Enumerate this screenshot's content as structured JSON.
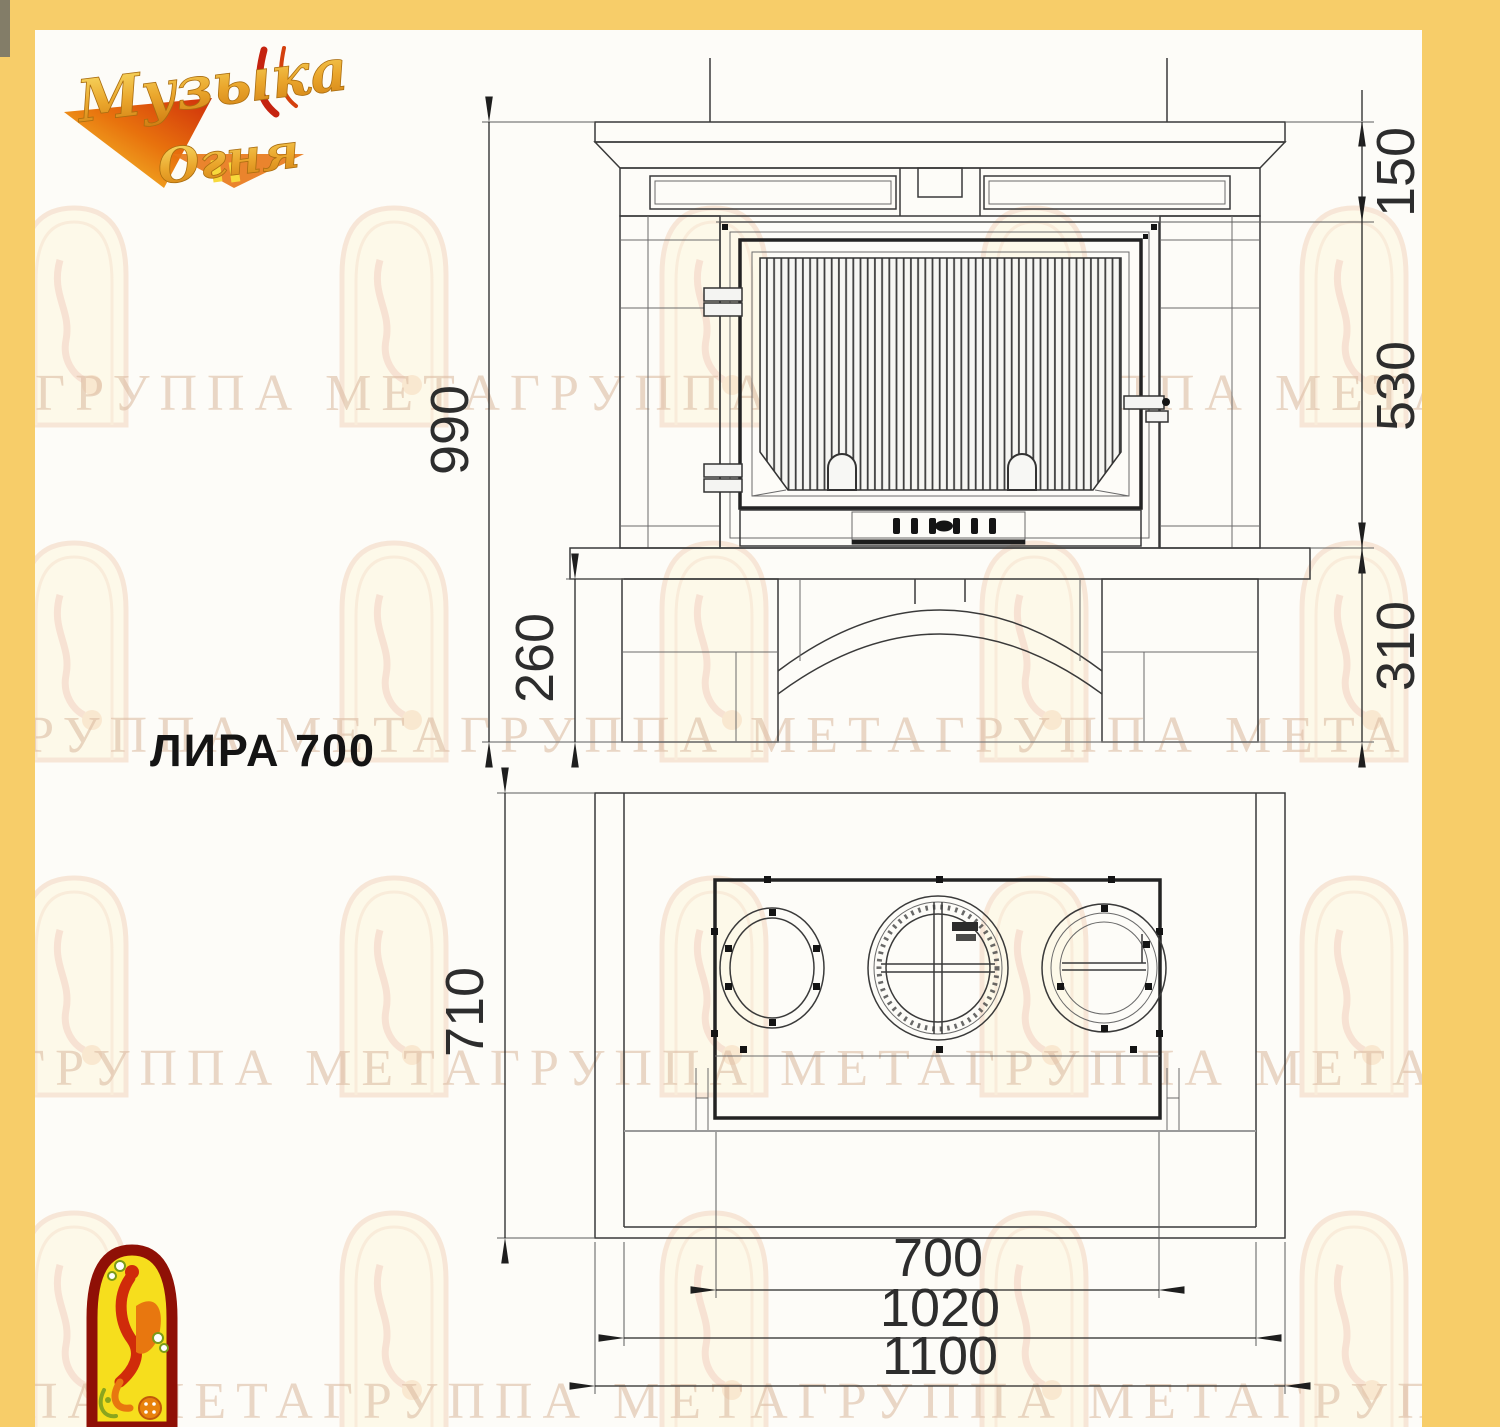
{
  "colors": {
    "frame_yellow": "#f7cd69",
    "paper_white": "#fdfcf8",
    "drawing_line": "#3a3a3a",
    "logo_gold": "#eaa62c",
    "logo_red": "#c52310",
    "firebird_arch_red": "#8f1006",
    "firebird_arch_yellow": "#f6de1d",
    "watermark_tone": "#dcbca4"
  },
  "brand_logo": {
    "word1": "Музыка",
    "word2": "Огня"
  },
  "model": {
    "label": "ЛИРА 700"
  },
  "front_view": {
    "dim_total_height": "990",
    "dim_mantel_height": "150",
    "dim_firebox_height": "530",
    "dim_base_height": "310",
    "dim_plinth_height": "260"
  },
  "plan_view": {
    "dim_depth": "710",
    "dim_insert_width": "700",
    "dim_platform_width": "1020",
    "dim_overall_width": "1100"
  },
  "watermark": {
    "rows": [
      "ГРУППА МЕТАГРУППА МЕТАГРУППА МЕТА",
      "ГРУППА МЕТАГРУППА МЕТАГРУППА МЕТА",
      "ГРУППА МЕТАГРУППА МЕТАГРУППА МЕТА",
      "ПА МЕТАГРУППА МЕТАГРУППА МЕТАГРУППА"
    ]
  }
}
